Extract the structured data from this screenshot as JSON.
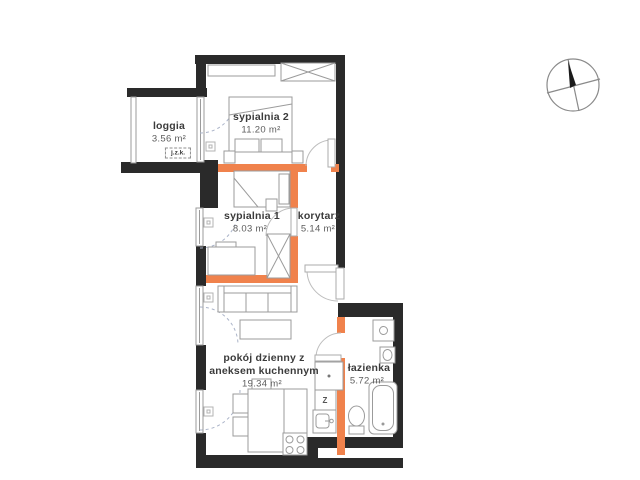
{
  "colors": {
    "wall": "#2A2A2A",
    "accent": "#F0824C",
    "outline": "#9B9B9B",
    "window": "#9B9B9B",
    "dash": "#AAB3C8",
    "text_dark": "#3B3B3B",
    "text_light": "#5C5C5C"
  },
  "rooms": [
    {
      "id": "loggia",
      "name": "loggia",
      "area": "3.56 m²"
    },
    {
      "id": "sypialnia-2",
      "name": "sypialnia 2",
      "area": "11.20 m²"
    },
    {
      "id": "sypialnia-1",
      "name": "sypialnia 1",
      "area": "8.03 m²"
    },
    {
      "id": "korytarz",
      "name": "korytarz",
      "area": "5.14 m²"
    },
    {
      "id": "pokoj-dzienny",
      "name_line1": "pokój dzienny z",
      "name_line2": "aneksem kuchennym",
      "area": "19.34 m²"
    },
    {
      "id": "lazienka",
      "name": "łazienka",
      "area": "5.72 m²"
    }
  ],
  "annotations": {
    "loggia_tag": "j.z.k.",
    "dishwasher_label": "Z"
  }
}
